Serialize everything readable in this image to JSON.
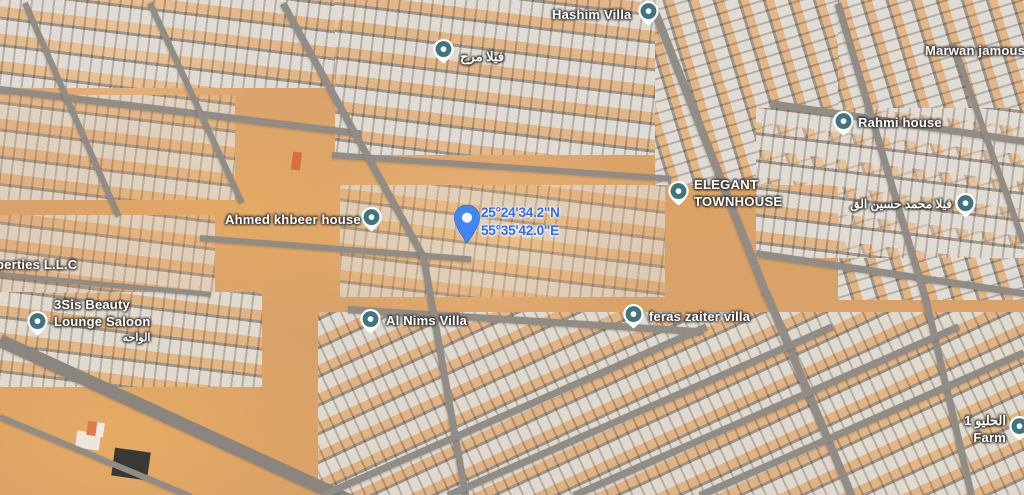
{
  "map": {
    "view_type": "satellite",
    "colors": {
      "sand": "#d9a06b",
      "road": "#918c86",
      "rooftop_light": "#d9d4cb",
      "rooftop_shadow": "#857c71",
      "poi_pin_teal": "#40747e",
      "dropped_pin_blue": "#4285f4",
      "label_text": "#ffffff",
      "coordinate_text": "#2a6df5"
    },
    "dropped_pin": {
      "line1": "25°24'34.2\"N",
      "line2": "55°35'42.0\"E"
    },
    "labels": [
      {
        "name": "hashim-villa",
        "text": "Hashim Villa",
        "pin": "teal"
      },
      {
        "name": "villa-marah",
        "text": "فيلا مرح",
        "pin": "teal"
      },
      {
        "name": "marwan-jamous",
        "text": "Marwan jamous",
        "pin": "none"
      },
      {
        "name": "rahmi-house",
        "text": "Rahmi house",
        "pin": "teal"
      },
      {
        "name": "villa-mohammed-hussain",
        "text": "فيلا محمد حسين الق",
        "pin": "teal"
      },
      {
        "name": "elegant-townhouse",
        "line1": "ELEGANT",
        "line2": "TOWNHOUSE",
        "pin": "teal"
      },
      {
        "name": "ahmed-khbeer-house",
        "text": "Ahmed khbeer house",
        "pin": "teal"
      },
      {
        "name": "properties-llc",
        "text": "perties L.L.C",
        "pin": "none"
      },
      {
        "name": "threesis-beauty-lounge-saloon",
        "line1": "3Sis Beauty",
        "line2": "Lounge Saloon",
        "line3": "الواحه",
        "pin": "teal"
      },
      {
        "name": "al-nims-villa",
        "text": "Al Nims Villa",
        "pin": "teal"
      },
      {
        "name": "feras-zaiter-villa",
        "text": "feras zaiter villa",
        "pin": "teal"
      },
      {
        "name": "helio-1-farm",
        "line1": "الحليو 1",
        "line2": "Farm",
        "pin": "teal"
      }
    ]
  }
}
